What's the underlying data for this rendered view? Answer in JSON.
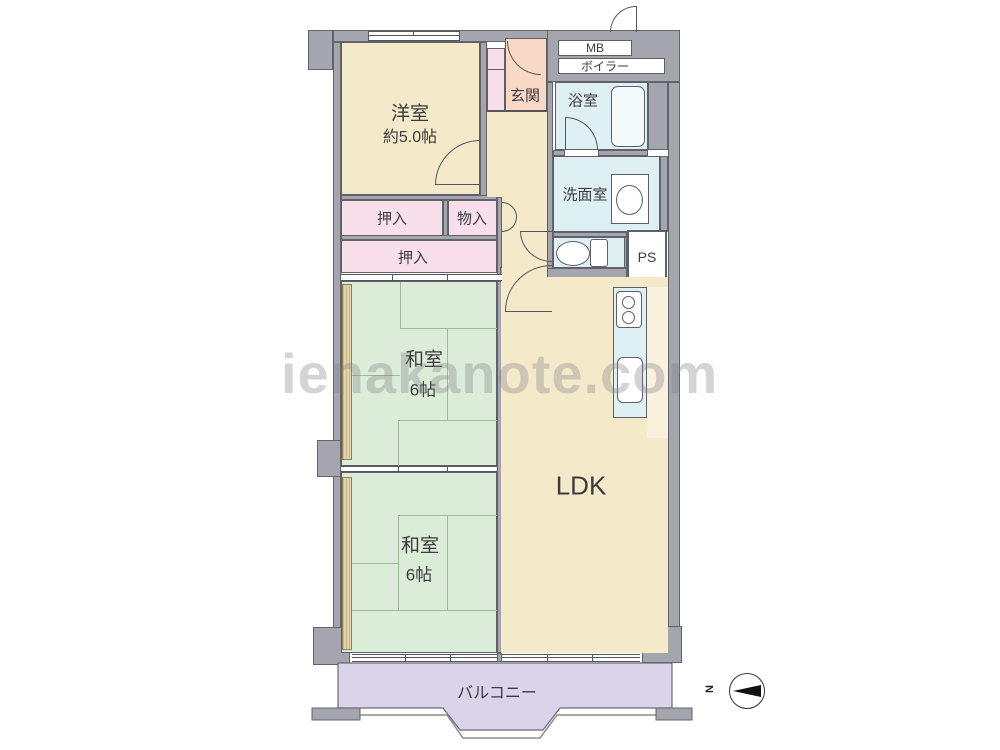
{
  "watermark": "ienakanote.com",
  "compass": {
    "north_label": "N"
  },
  "rooms": {
    "western": {
      "name": "洋室",
      "size": "約5.0帖"
    },
    "entrance": {
      "name": "玄関"
    },
    "meter_box": {
      "name": "MB"
    },
    "boiler": {
      "name": "ボイラー"
    },
    "bathroom": {
      "name": "浴室"
    },
    "washroom": {
      "name": "洗面室"
    },
    "pipe_shaft": {
      "name": "PS"
    },
    "closet_upper": {
      "name": "押入"
    },
    "storage": {
      "name": "物入"
    },
    "closet_lower": {
      "name": "押入"
    },
    "japanese1": {
      "name": "和室",
      "size": "6帖"
    },
    "japanese2": {
      "name": "和室",
      "size": "6帖"
    },
    "ldk": {
      "name": "LDK"
    },
    "balcony": {
      "name": "バルコニー"
    }
  },
  "colors": {
    "wall": "#A5A5AD",
    "room_cream": "#F4EACA",
    "room_pink": "#F9DFEC",
    "room_green": "#DBEDD8",
    "room_blue": "#DFF0F4",
    "room_peach": "#F9D8C5",
    "balcony_purple": "#DBD3EA"
  }
}
